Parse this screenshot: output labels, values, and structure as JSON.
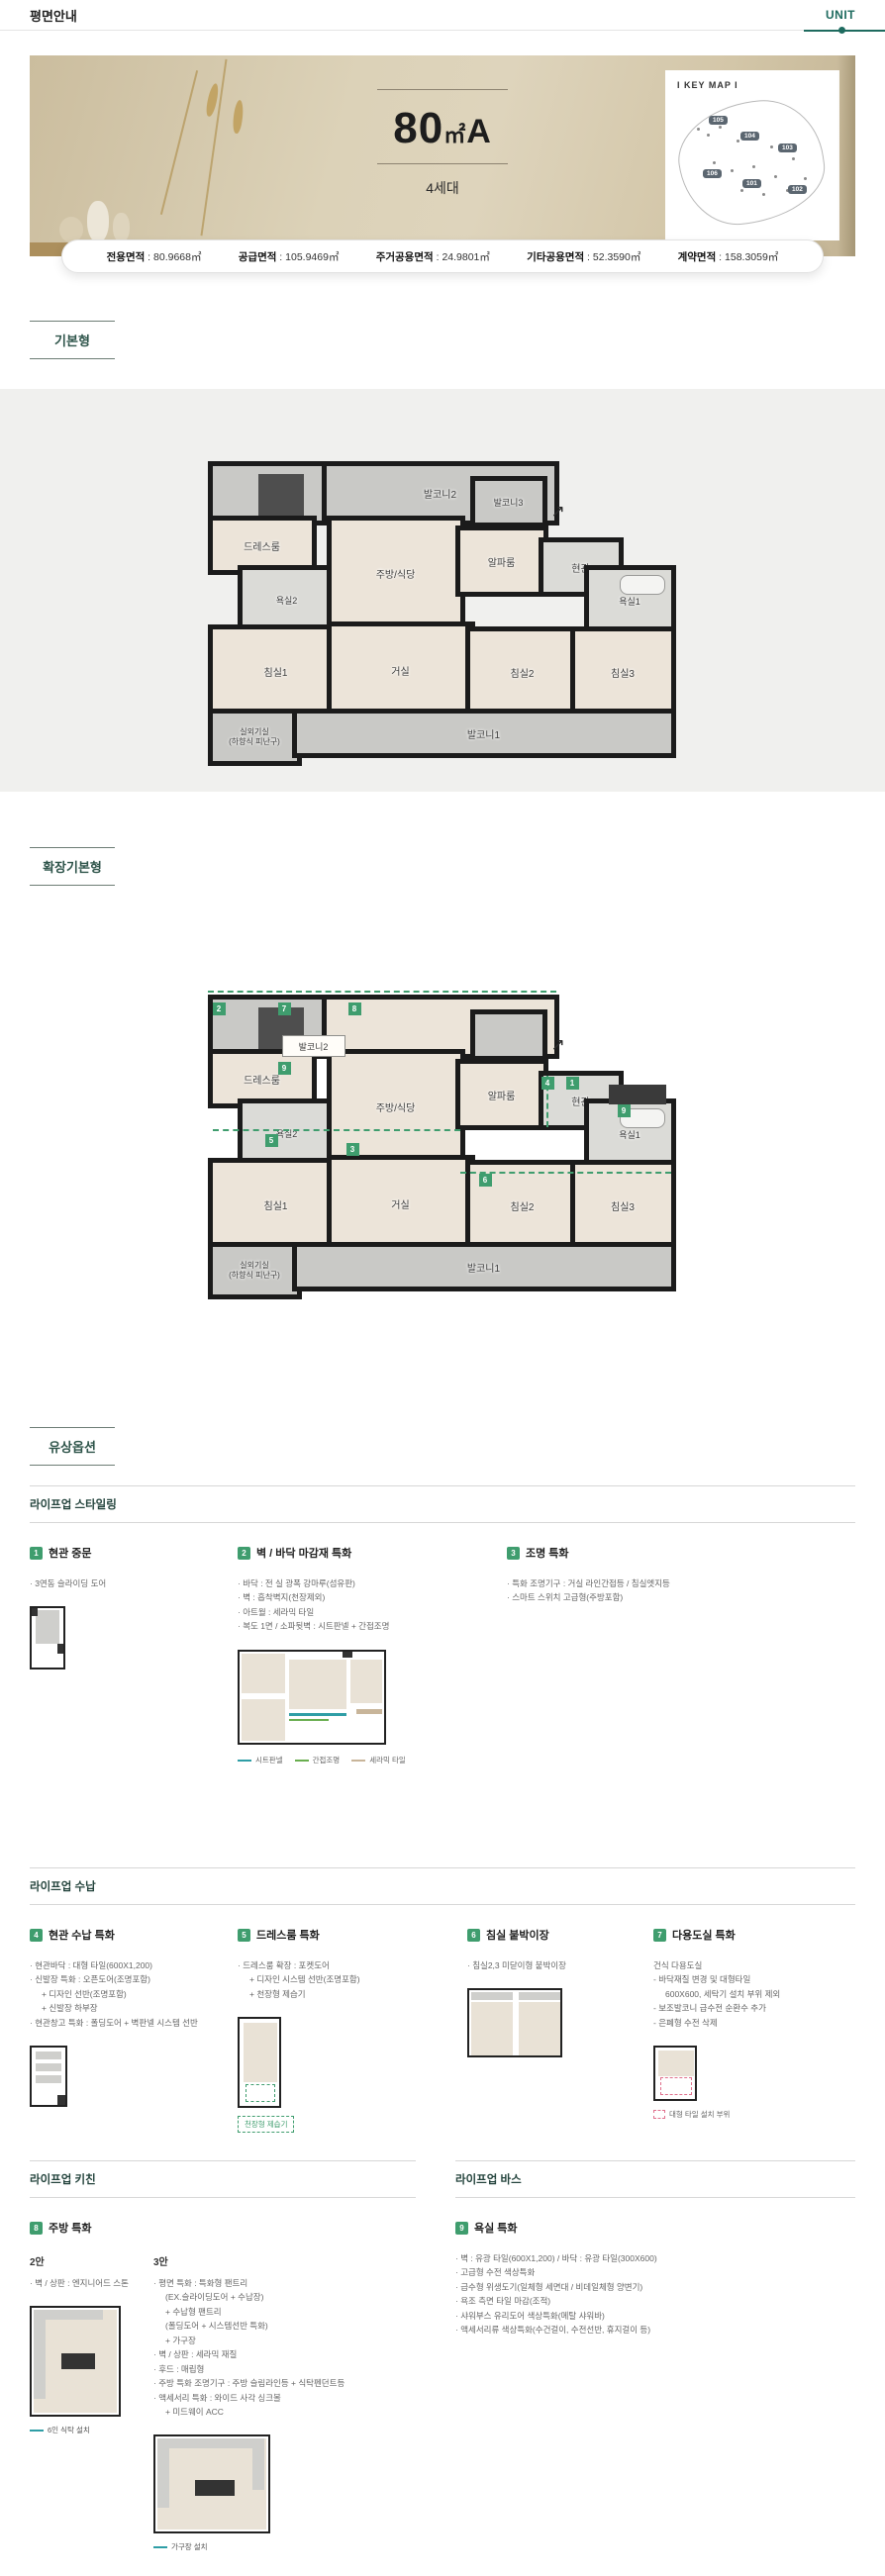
{
  "colors": {
    "accent": "#1e6b5f",
    "badge_green": "#3f9d6e",
    "legend_sheet": "#2f9ea6",
    "legend_light": "#69ae4f",
    "legend_ceramic": "#c8b59a"
  },
  "header": {
    "title": "평면안내",
    "unit_tab": "UNIT"
  },
  "hero": {
    "size_num": "80",
    "size_unit": "㎡",
    "size_type": "A",
    "households": "4세대",
    "keymap_title": "I KEY MAP I",
    "keymap_chips": [
      "105",
      "104",
      "103",
      "106",
      "101",
      "102"
    ]
  },
  "areas": [
    {
      "label": "전용면적",
      "value": "80.9668㎡"
    },
    {
      "label": "공급면적",
      "value": "105.9469㎡"
    },
    {
      "label": "주거공용면적",
      "value": "24.9801㎡"
    },
    {
      "label": "기타공용면적",
      "value": "52.3590㎡"
    },
    {
      "label": "계약면적",
      "value": "158.3059㎡"
    }
  ],
  "sections": {
    "basic": "기본형",
    "extended": "확장기본형",
    "options": "유상옵션"
  },
  "rooms": {
    "balcony1": "발코니1",
    "balcony2": "발코니2",
    "balcony3": "발코니3",
    "dress": "드레스룸",
    "bath2": "욕실2",
    "kitchen": "주방/식당",
    "alpha": "알파룸",
    "entry": "현관",
    "bath1": "욕실1",
    "bed1": "침실1",
    "living": "거실",
    "bed2": "침실2",
    "bed3": "침실3",
    "outdoor": "실외기실",
    "outdoor_sub": "(하향식 피난구)",
    "arrow": "↗"
  },
  "ext_badges": {
    "p2": "2",
    "p7": "7",
    "p8": "8",
    "p9a": "9",
    "p5": "5",
    "p3": "3",
    "p4": "4",
    "p1": "1",
    "p9b": "9",
    "p6": "6"
  },
  "lifeup": [
    {
      "heading": "라이프업 스타일링",
      "items": [
        {
          "num": "1",
          "title": "현관 중문",
          "bullets": [
            "· 3연동 슬라이딩 도어"
          ]
        },
        {
          "num": "2",
          "title": "벽 / 바닥 마감재 특화",
          "bullets": [
            "· 바닥 : 전 실 광폭 강마루(섬유판)",
            "· 벽 : 흡착벽지(천장제외)",
            "· 아트월 : 세라믹 타일",
            "· 복도 1면 / 소파뒷벽 : 시트판넬 + 간접조명"
          ],
          "legend": [
            {
              "label": "시트판넬"
            },
            {
              "label": "간접조명"
            },
            {
              "label": "세라믹 타일"
            }
          ]
        },
        {
          "num": "3",
          "title": "조명 특화",
          "bullets": [
            "· 특화 조명기구 : 거실 라인간접등 / 침실엣지등",
            "· 스마트 스위치 고급형(주방포함)"
          ]
        }
      ]
    },
    {
      "heading": "라이프업 수납",
      "items": [
        {
          "num": "4",
          "title": "현관 수납 특화",
          "bullets": [
            "· 현관바닥 : 대형 타일(600X1,200)",
            "· 신발장 특화 : 오픈도어(조명포함)",
            "+ 디자인 선반(조명포함)",
            "+ 신발장 하부장",
            "· 현관창고 특화 : 폴딩도어 + 벽판넬 시스템 선반"
          ]
        },
        {
          "num": "5",
          "title": "드레스룸 특화",
          "bullets": [
            "· 드레스룸 확장 : 포켓도어",
            "+ 디자인 시스템 선반(조명포함)",
            "+ 천장형 제습기"
          ],
          "caption": "천장형 제습기"
        },
        {
          "num": "6",
          "title": "침실 붙박이장",
          "bullets": [
            "· 침실2,3 미닫이형 붙박이장"
          ]
        },
        {
          "num": "7",
          "title": "다용도실 특화",
          "bullets": [
            "건식 다용도실",
            "- 바닥재질 변경 및 대형타일",
            "600X600, 세탁기 설치 부위 제외",
            "- 보조발코니 급수전 순환수 추가",
            "- 은폐형 수전 삭제"
          ],
          "legend_caption": "대형 타일 설치 부위"
        }
      ]
    },
    {
      "heading": "라이프업 키친",
      "items": [
        {
          "num": "8",
          "title": "주방 특화",
          "plan2_label": "2안",
          "plan2_bullets": [
            "· 벽 / 상판 : 엔지니어드 스톤"
          ],
          "plan2_caption": "6인 식탁 설치",
          "plan3_label": "3안",
          "plan3_bullets": [
            "· 평면 특화 : 특화형 팬트리",
            "(EX.슬라이딩도어 + 수납장)",
            "+ 수납형 팬트리",
            "(폴딩도어 + 시스템선반 특화)",
            "+ 가구장",
            "· 벽 / 상판 : 세라믹 재질",
            "· 후드 : 매립형",
            "· 주방 특화 조명기구 : 주방 슬림라인등 + 식탁펜던트등",
            "· 액세서리 특화 : 와이드 사각 싱크볼",
            "+ 미드웨이 ACC"
          ],
          "plan3_caption": "가구장 설치"
        }
      ]
    },
    {
      "heading": "라이프업 바스",
      "items": [
        {
          "num": "9",
          "title": "욕실 특화",
          "bullets": [
            "· 벽 : 유광 타일(600X1,200) / 바닥 : 유광 타일(300X600)",
            "· 고급형 수전 색상특화",
            "· 급수형 위생도기(일체형 세면대 / 비데일체형 양변기)",
            "· 욕조 측면 타일 마감(조적)",
            "· 샤워부스 유리도어 색상특화(메탈 샤워바)",
            "· 액세서리류 색상특화(수건걸이, 수전선반, 휴지걸이 등)"
          ]
        }
      ]
    }
  ]
}
